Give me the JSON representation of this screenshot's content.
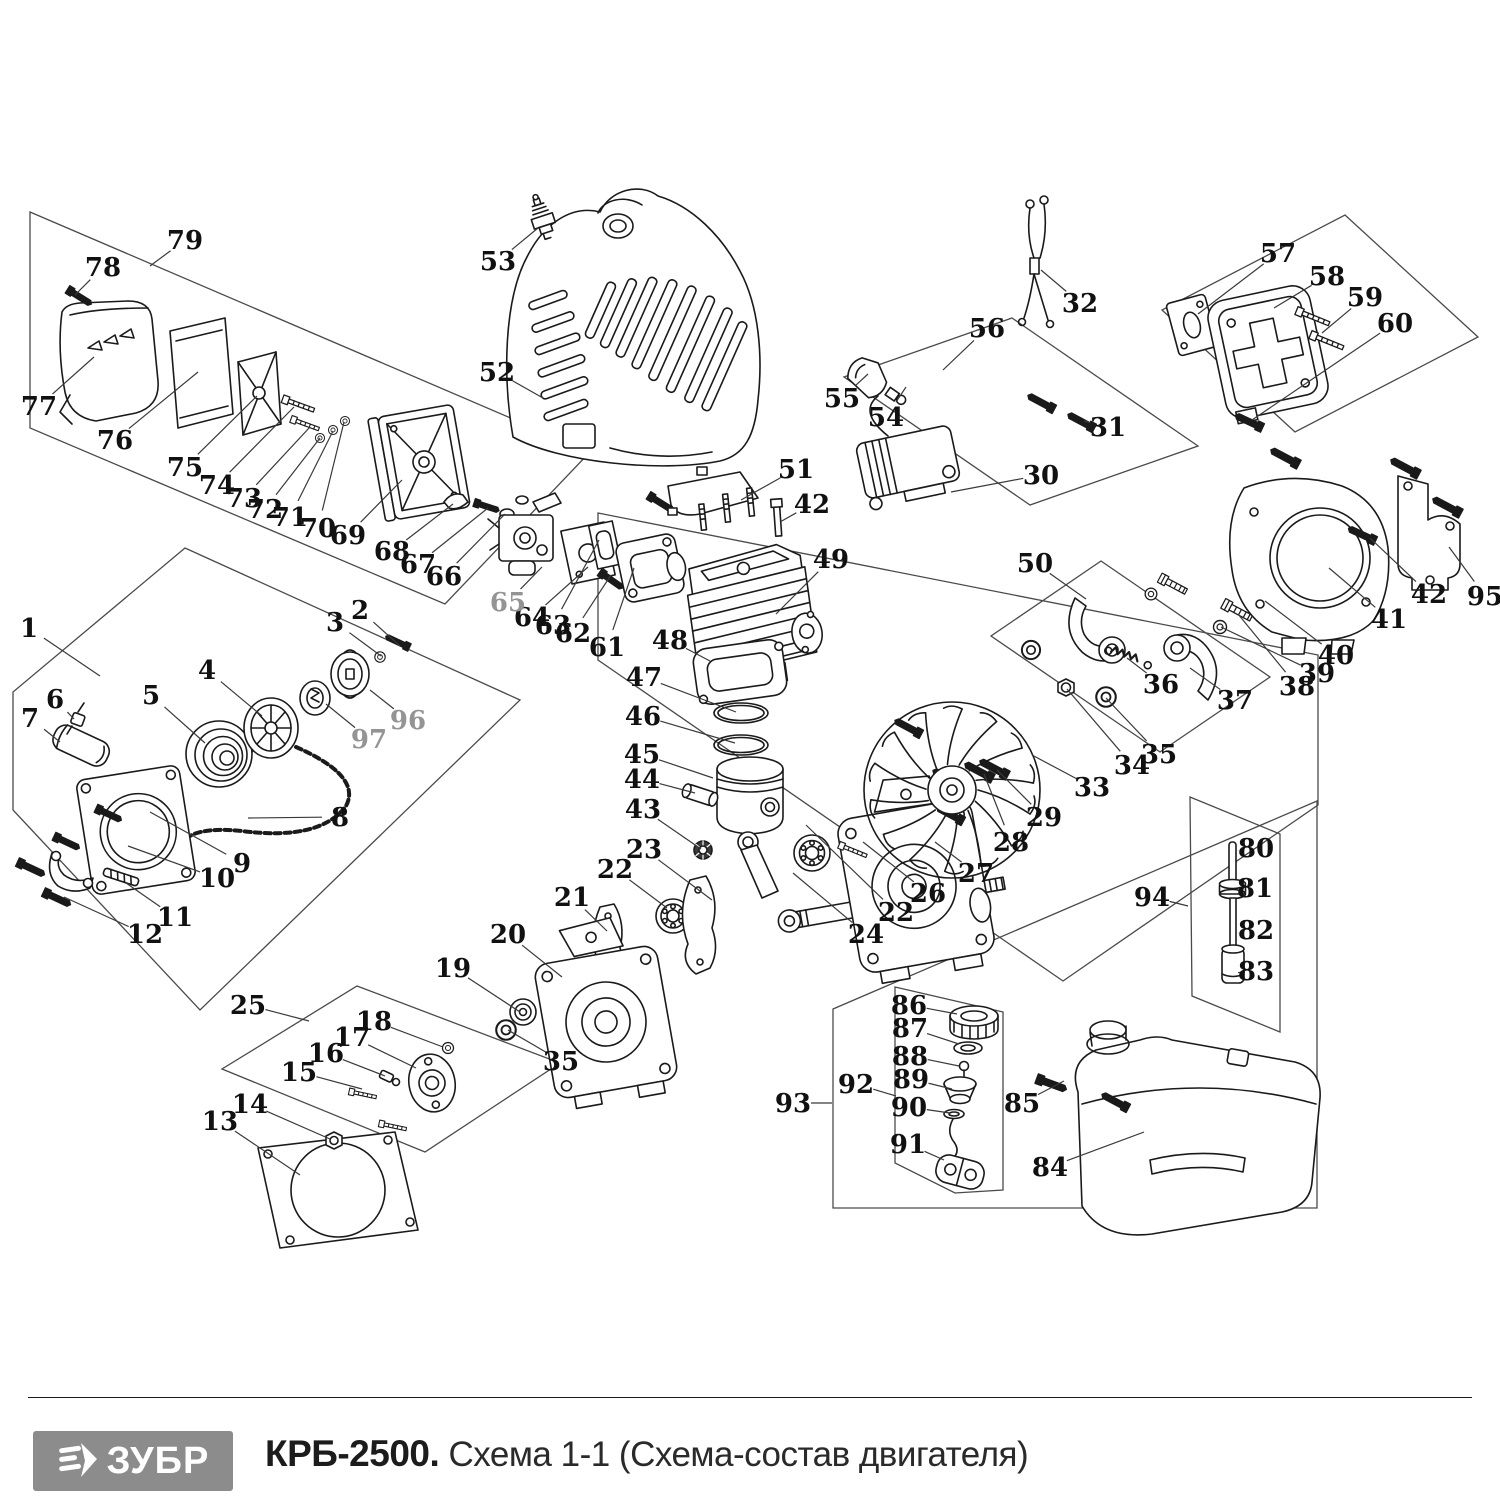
{
  "footer": {
    "brand": "ЗУБР",
    "model": "КРБ-2500.",
    "subtitle": " Схема 1-1 (Схема-состав двигателя)"
  },
  "colors": {
    "part_line": "#1a1a1a",
    "box_line": "#4a4a4a",
    "leader": "#3a3a3a",
    "label": "#111111",
    "label_muted": "#949494",
    "logo_bg": "#8c8c8c",
    "logo_text": "#ffffff"
  },
  "labels": [
    {
      "n": "1",
      "x": 29,
      "y": 628,
      "tx": 100,
      "ty": 676
    },
    {
      "n": "2",
      "x": 360,
      "y": 610,
      "tx": 400,
      "ty": 646
    },
    {
      "n": "3",
      "x": 335,
      "y": 622,
      "tx": 381,
      "ty": 656
    },
    {
      "n": "4",
      "x": 207,
      "y": 670,
      "tx": 262,
      "ty": 716
    },
    {
      "n": "5",
      "x": 151,
      "y": 695,
      "tx": 205,
      "ty": 743
    },
    {
      "n": "6",
      "x": 55,
      "y": 699,
      "tx": 74,
      "ty": 719
    },
    {
      "n": "7",
      "x": 30,
      "y": 718,
      "tx": 60,
      "ty": 742
    },
    {
      "n": "8",
      "x": 340,
      "y": 817,
      "tx": 248,
      "ty": 818
    },
    {
      "n": "9",
      "x": 242,
      "y": 863,
      "tx": 150,
      "ty": 812
    },
    {
      "n": "10",
      "x": 217,
      "y": 878,
      "tx": 128,
      "ty": 846
    },
    {
      "n": "11",
      "x": 175,
      "y": 917,
      "tx": 126,
      "ty": 883
    },
    {
      "n": "12",
      "x": 145,
      "y": 934,
      "tx": 64,
      "ty": 897
    },
    {
      "n": "13",
      "x": 220,
      "y": 1121,
      "tx": 300,
      "ty": 1175
    },
    {
      "n": "14",
      "x": 250,
      "y": 1104,
      "tx": 330,
      "ty": 1139
    },
    {
      "n": "15",
      "x": 299,
      "y": 1072,
      "tx": 362,
      "ty": 1089
    },
    {
      "n": "16",
      "x": 326,
      "y": 1053,
      "tx": 385,
      "ty": 1076
    },
    {
      "n": "17",
      "x": 352,
      "y": 1037,
      "tx": 416,
      "ty": 1068
    },
    {
      "n": "18",
      "x": 374,
      "y": 1021,
      "tx": 443,
      "ty": 1047
    },
    {
      "n": "19",
      "x": 453,
      "y": 968,
      "tx": 520,
      "ty": 1012
    },
    {
      "n": "20",
      "x": 508,
      "y": 934,
      "tx": 562,
      "ty": 977
    },
    {
      "n": "21",
      "x": 572,
      "y": 897,
      "tx": 607,
      "ty": 931
    },
    {
      "n": "22",
      "x": 615,
      "y": 869,
      "tx": 667,
      "ty": 908
    },
    {
      "n": "22",
      "x": 896,
      "y": 912,
      "tx": 806,
      "ty": 825
    },
    {
      "n": "23",
      "x": 644,
      "y": 849,
      "tx": 712,
      "ty": 900
    },
    {
      "n": "24",
      "x": 866,
      "y": 934,
      "tx": 793,
      "ty": 873
    },
    {
      "n": "25",
      "x": 248,
      "y": 1005,
      "tx": 309,
      "ty": 1021
    },
    {
      "n": "26",
      "x": 928,
      "y": 893,
      "tx": 863,
      "ty": 842
    },
    {
      "n": "27",
      "x": 976,
      "y": 873,
      "tx": 935,
      "ty": 842
    },
    {
      "n": "28",
      "x": 1011,
      "y": 842,
      "tx": 984,
      "ty": 774
    },
    {
      "n": "29",
      "x": 1044,
      "y": 817,
      "tx": 997,
      "ty": 770
    },
    {
      "n": "30",
      "x": 1041,
      "y": 475,
      "tx": 951,
      "ty": 492
    },
    {
      "n": "31",
      "x": 1108,
      "y": 427,
      "tx": 1084,
      "ty": 421
    },
    {
      "n": "32",
      "x": 1080,
      "y": 303,
      "tx": 1041,
      "ty": 270
    },
    {
      "n": "33",
      "x": 1092,
      "y": 787,
      "tx": 1032,
      "ty": 755
    },
    {
      "n": "34",
      "x": 1132,
      "y": 765,
      "tx": 1067,
      "ty": 689
    },
    {
      "n": "35",
      "x": 1159,
      "y": 754,
      "tx": 1106,
      "ty": 698
    },
    {
      "n": "35",
      "x": 561,
      "y": 1061,
      "tx": 508,
      "ty": 1030
    },
    {
      "n": "36",
      "x": 1161,
      "y": 684,
      "tx": 1127,
      "ty": 658
    },
    {
      "n": "37",
      "x": 1235,
      "y": 700,
      "tx": 1190,
      "ty": 668
    },
    {
      "n": "38",
      "x": 1297,
      "y": 686,
      "tx": 1238,
      "ty": 614
    },
    {
      "n": "39",
      "x": 1317,
      "y": 673,
      "tx": 1221,
      "ty": 627
    },
    {
      "n": "40",
      "x": 1336,
      "y": 655,
      "tx": 1265,
      "ty": 601
    },
    {
      "n": "41",
      "x": 1389,
      "y": 619,
      "tx": 1329,
      "ty": 568
    },
    {
      "n": "42",
      "x": 812,
      "y": 504,
      "tx": 780,
      "ty": 522
    },
    {
      "n": "42",
      "x": 1429,
      "y": 594,
      "tx": 1370,
      "ty": 538
    },
    {
      "n": "43",
      "x": 643,
      "y": 809,
      "tx": 701,
      "ty": 849
    },
    {
      "n": "44",
      "x": 642,
      "y": 779,
      "tx": 695,
      "ty": 793
    },
    {
      "n": "45",
      "x": 642,
      "y": 754,
      "tx": 713,
      "ty": 778
    },
    {
      "n": "46",
      "x": 643,
      "y": 716,
      "tx": 735,
      "ty": 743
    },
    {
      "n": "47",
      "x": 644,
      "y": 677,
      "tx": 736,
      "ty": 712
    },
    {
      "n": "48",
      "x": 670,
      "y": 640,
      "tx": 710,
      "ty": 661
    },
    {
      "n": "49",
      "x": 831,
      "y": 559,
      "tx": 776,
      "ty": 614
    },
    {
      "n": "50",
      "x": 1035,
      "y": 563,
      "tx": 1086,
      "ty": 599
    },
    {
      "n": "51",
      "x": 796,
      "y": 469,
      "tx": 741,
      "ty": 500
    },
    {
      "n": "52",
      "x": 497,
      "y": 372,
      "tx": 543,
      "ty": 398
    },
    {
      "n": "53",
      "x": 498,
      "y": 261,
      "tx": 538,
      "ty": 228
    },
    {
      "n": "54",
      "x": 886,
      "y": 417,
      "tx": 906,
      "ty": 387
    },
    {
      "n": "55",
      "x": 842,
      "y": 398,
      "tx": 868,
      "ty": 374
    },
    {
      "n": "56",
      "x": 987,
      "y": 328,
      "tx": 943,
      "ty": 370
    },
    {
      "n": "57",
      "x": 1278,
      "y": 253,
      "tx": 1198,
      "ty": 314
    },
    {
      "n": "58",
      "x": 1327,
      "y": 276,
      "tx": 1274,
      "ty": 308
    },
    {
      "n": "59",
      "x": 1365,
      "y": 297,
      "tx": 1322,
      "ty": 333
    },
    {
      "n": "60",
      "x": 1395,
      "y": 323,
      "tx": 1252,
      "ty": 420
    },
    {
      "n": "61",
      "x": 607,
      "y": 647,
      "tx": 634,
      "ty": 568
    },
    {
      "n": "62",
      "x": 573,
      "y": 633,
      "tx": 611,
      "ty": 575
    },
    {
      "n": "63",
      "x": 553,
      "y": 625,
      "tx": 599,
      "ty": 540
    },
    {
      "n": "64",
      "x": 532,
      "y": 617,
      "tx": 588,
      "ty": 567
    },
    {
      "n": "65",
      "x": 508,
      "y": 602,
      "tx": 542,
      "ty": 567,
      "muted": true
    },
    {
      "n": "66",
      "x": 444,
      "y": 576,
      "tx": 505,
      "ty": 514
    },
    {
      "n": "67",
      "x": 418,
      "y": 564,
      "tx": 488,
      "ty": 508
    },
    {
      "n": "68",
      "x": 392,
      "y": 551,
      "tx": 453,
      "ty": 504
    },
    {
      "n": "69",
      "x": 348,
      "y": 535,
      "tx": 402,
      "ty": 480
    },
    {
      "n": "70",
      "x": 318,
      "y": 528,
      "tx": 344,
      "ty": 422
    },
    {
      "n": "71",
      "x": 290,
      "y": 517,
      "tx": 333,
      "ty": 431
    },
    {
      "n": "72",
      "x": 265,
      "y": 509,
      "tx": 320,
      "ty": 438
    },
    {
      "n": "73",
      "x": 244,
      "y": 498,
      "tx": 310,
      "ty": 427
    },
    {
      "n": "74",
      "x": 217,
      "y": 485,
      "tx": 294,
      "ty": 407
    },
    {
      "n": "75",
      "x": 185,
      "y": 467,
      "tx": 257,
      "ty": 396
    },
    {
      "n": "76",
      "x": 115,
      "y": 440,
      "tx": 198,
      "ty": 372
    },
    {
      "n": "77",
      "x": 39,
      "y": 406,
      "tx": 94,
      "ty": 357
    },
    {
      "n": "78",
      "x": 103,
      "y": 267,
      "tx": 75,
      "ty": 295
    },
    {
      "n": "79",
      "x": 185,
      "y": 240,
      "tx": 150,
      "ty": 266
    },
    {
      "n": "80",
      "x": 1256,
      "y": 848,
      "tx": 1238,
      "ty": 851
    },
    {
      "n": "81",
      "x": 1255,
      "y": 888,
      "tx": 1240,
      "ty": 890
    },
    {
      "n": "82",
      "x": 1256,
      "y": 930,
      "tx": 1238,
      "ty": 933
    },
    {
      "n": "83",
      "x": 1256,
      "y": 971,
      "tx": 1245,
      "ty": 972
    },
    {
      "n": "84",
      "x": 1050,
      "y": 1167,
      "tx": 1144,
      "ty": 1132
    },
    {
      "n": "85",
      "x": 1022,
      "y": 1103,
      "tx": 1064,
      "ty": 1081
    },
    {
      "n": "86",
      "x": 909,
      "y": 1005,
      "tx": 957,
      "ty": 1014
    },
    {
      "n": "87",
      "x": 910,
      "y": 1028,
      "tx": 959,
      "ty": 1044
    },
    {
      "n": "88",
      "x": 910,
      "y": 1056,
      "tx": 959,
      "ty": 1066
    },
    {
      "n": "89",
      "x": 911,
      "y": 1079,
      "tx": 952,
      "ty": 1089
    },
    {
      "n": "90",
      "x": 909,
      "y": 1107,
      "tx": 950,
      "ty": 1113
    },
    {
      "n": "91",
      "x": 908,
      "y": 1144,
      "tx": 944,
      "ty": 1160
    },
    {
      "n": "92",
      "x": 856,
      "y": 1084,
      "tx": 896,
      "ty": 1096
    },
    {
      "n": "93",
      "x": 793,
      "y": 1103,
      "tx": 832,
      "ty": 1103
    },
    {
      "n": "94",
      "x": 1152,
      "y": 897,
      "tx": 1188,
      "ty": 906
    },
    {
      "n": "95",
      "x": 1485,
      "y": 596,
      "tx": 1449,
      "ty": 547
    },
    {
      "n": "96",
      "x": 408,
      "y": 720,
      "tx": 370,
      "ty": 690,
      "muted": true
    },
    {
      "n": "97",
      "x": 369,
      "y": 739,
      "tx": 326,
      "ty": 704,
      "muted": true
    }
  ]
}
